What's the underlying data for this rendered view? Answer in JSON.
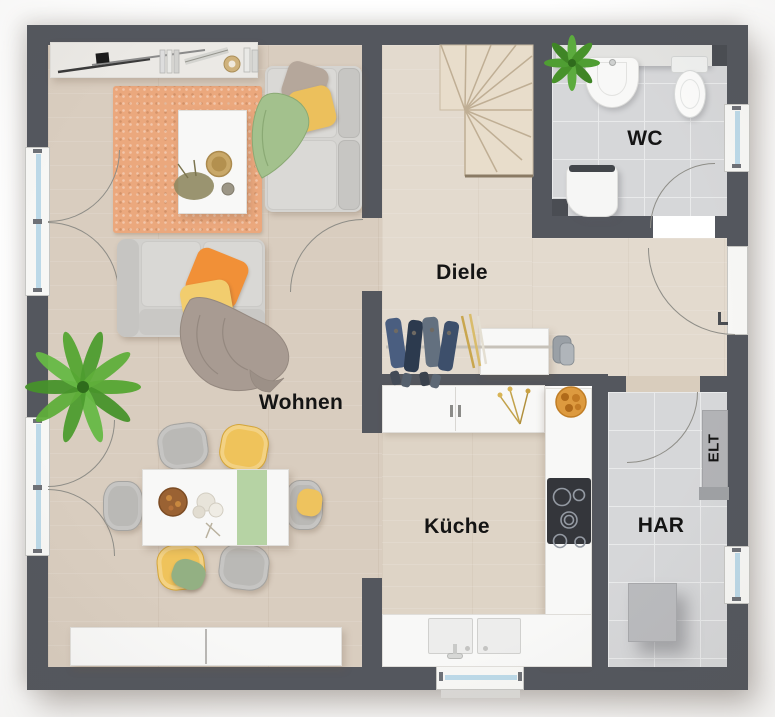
{
  "rooms": {
    "wohnen": {
      "label": "Wohnen"
    },
    "diele": {
      "label": "Diele"
    },
    "wc": {
      "label": "WC"
    },
    "kueche": {
      "label": "Küche"
    },
    "har": {
      "label": "HAR"
    },
    "elt": {
      "label": "ELT"
    }
  },
  "palette": {
    "wall": "#54575e",
    "floor_wood": "#d9cdbf",
    "floor_wood_light": "#e3dace",
    "floor_tile": "#d6d7d9",
    "rug": "#eba87d",
    "sofa_gray": "#d3d2cf",
    "pillow_orange": "#f19037",
    "pillow_yellow": "#eec35e",
    "blanket_green": "#a3c18d",
    "chair_yellow": "#efc35b",
    "plant_green": "#55a532",
    "window_glass": "#bcd9e8",
    "counter_white": "#f5f5f3"
  }
}
